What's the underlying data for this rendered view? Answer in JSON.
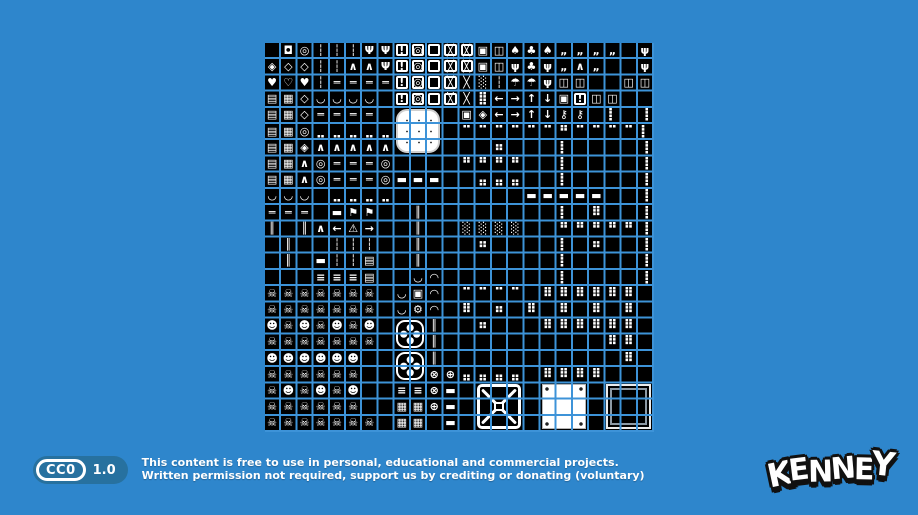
{
  "page": {
    "background_color": "#2e86cc"
  },
  "tileset": {
    "description": "1-bit monochrome tileset preview, 24x24 tiles, white pixel art on black with blue grid lines",
    "columns": 24,
    "rows": 24,
    "tile_color": "#000000",
    "ink_color": "#ffffff",
    "grid_line_color": "#3d93d8",
    "legend": {
      ".": {
        "glyph": "",
        "label": "empty-tile"
      },
      "$": {
        "glyph": "◘",
        "label": "small-button"
      },
      "0": {
        "glyph": "◎",
        "label": "ring-button"
      },
      "o": {
        "glyph": "▣",
        "label": "boxed-button"
      },
      "e": {
        "glyph": "◈",
        "label": "ornate-gem"
      },
      "G": {
        "glyph": "◇",
        "label": "gem-outline"
      },
      "h": {
        "glyph": "♥",
        "label": "heart"
      },
      "H": {
        "glyph": "♡",
        "label": "heart-outline"
      },
      "i": {
        "glyph": "┆",
        "label": "chain"
      },
      "k": {
        "glyph": "Ψ",
        "label": "grapple-hook"
      },
      "K": {
        "glyph": "⚷",
        "label": "key"
      },
      "b": {
        "glyph": "!",
        "frame": true,
        "label": "exclamation-box"
      },
      "C": {
        "glyph": "◎",
        "frame": true,
        "label": "button-box"
      },
      "d": {
        "glyph": "",
        "frame": true,
        "label": "empty-box"
      },
      "X": {
        "glyph": "╳",
        "frame": true,
        "label": "crossed-box"
      },
      "x": {
        "glyph": "╳",
        "label": "cross-tile"
      },
      "L": {
        "glyph": "▤",
        "label": "ladder"
      },
      "r": {
        "glyph": "▦",
        "label": "rails"
      },
      "t": {
        "glyph": "♠",
        "label": "tree-small"
      },
      "T": {
        "glyph": "♣",
        "label": "tree-large"
      },
      "m": {
        "glyph": "☂",
        "label": "mushroom"
      },
      "p": {
        "glyph": "ψ",
        "label": "plant"
      },
      "v": {
        "glyph": "„",
        "label": "grass-tuft"
      },
      "z": {
        "glyph": "∧",
        "label": "zigzag-spikes"
      },
      "~": {
        "glyph": "═",
        "label": "bridge-deck"
      },
      "(": {
        "glyph": "◡",
        "label": "hanging-rope-left"
      },
      ")": {
        "glyph": "◠",
        "label": "arch-rope"
      },
      "a": {
        "glyph": "→",
        "label": "arrow-right-sign"
      },
      "A": {
        "glyph": "←",
        "label": "arrow-left-sign"
      },
      "u": {
        "glyph": "↑",
        "label": "arrow-up-sign"
      },
      "n": {
        "glyph": "↓",
        "label": "arrow-down-sign"
      },
      "D": {
        "glyph": "◫",
        "label": "door"
      },
      "E": {
        "glyph": "⚑",
        "label": "signpost-flag"
      },
      "Y": {
        "glyph": "⚠",
        "label": "warning-sign"
      },
      "s": {
        "glyph": "☠",
        "label": "skull-creature"
      },
      "S": {
        "glyph": "☻",
        "label": "creature-face"
      },
      "f": {
        "glyph": "⊕",
        "label": "small-fan"
      },
      "j": {
        "glyph": "⊗",
        "label": "small-fan-x"
      },
      "I": {
        "glyph": "║",
        "label": "pipe-post"
      },
      "=": {
        "glyph": "≡",
        "label": "fence"
      },
      "@": {
        "glyph": "▬",
        "label": "platform"
      },
      "&": {
        "glyph": "⚙",
        "label": "gear"
      },
      "N": {
        "glyph": "░",
        "label": "hazard-stripes"
      },
      "8": {
        "glyph": "⣿",
        "size": 13,
        "label": "speckled-block"
      },
      "1": {
        "glyph": "⠛",
        "size": 13,
        "label": "dotted-edge-top"
      },
      "2": {
        "glyph": "⣤",
        "size": 13,
        "label": "dotted-edge-bottom"
      },
      "3": {
        "glyph": "⡇",
        "size": 13,
        "label": "dotted-edge-left"
      },
      "4": {
        "glyph": "⢸",
        "size": 13,
        "label": "dotted-edge-right"
      },
      "5": {
        "glyph": "⠿",
        "size": 13,
        "label": "dotted-terrain"
      },
      "6": {
        "glyph": "⣀",
        "size": 13,
        "label": "ground-dots"
      },
      "7": {
        "glyph": "⠉",
        "size": 13,
        "label": "ceiling-dots"
      },
      "9": {
        "glyph": "⠶",
        "size": 13,
        "label": "scatter-dots"
      }
    },
    "map": [
      ".$0iiikkbCdXXoDtTtvvvv.p",
      "eGGiizzkbCdXXoDpTpvzv..p",
      "hHhi~~~~bCdXxNimmpDD..DD",
      "LrG((((.bCdXx8AaunobDD..",
      "LrG~~~~.....oeAaunKK.3.4",
      "Lr066666....777777177773",
      "Lrezzzzz......9...3....4",
      "Lrz0~~~0....1111..3....4",
      "Lrz0~~~0@@@..222..3....4",
      "(((.6666........@@@@@..4",
      "~~~.@EE..I........3.5..4",
      "I.IzAYa..I..NNNN..111114",
      ".I..iii..I...9....3.9..4",
      ".I.@iiL..I........3....4",
      "...===L..().......3....4",
      "sssssss.(o).7777.555555.",
      "sssssss.(&).5.9.5.5.5.5.",
      "SsSsSsS...I..9...555555.",
      "sssssss...I..........55.",
      "SSSSSS....I...........5.",
      "ssssss....jf2222.5555...",
      "sSsSsS..==j@............",
      "ssssss..rrf@............",
      "sssssss.rr.@............"
    ],
    "overlays": [
      {
        "name": "white-rounded-blob",
        "type": "white-round",
        "col": 9,
        "row": 5,
        "cols": 3,
        "rows": 3
      },
      {
        "name": "large-fan-top",
        "type": "fan",
        "col": 9,
        "row": 18,
        "cols": 2,
        "rows": 2
      },
      {
        "name": "large-fan-bottom",
        "type": "fan",
        "col": 9,
        "row": 20,
        "cols": 2,
        "rows": 2
      },
      {
        "name": "crate-cross-3x3",
        "type": "crate",
        "col": 14,
        "row": 22,
        "cols": 3,
        "rows": 3
      },
      {
        "name": "white-square-3x3",
        "type": "white-square",
        "col": 18,
        "row": 22,
        "cols": 3,
        "rows": 3
      },
      {
        "name": "black-square-3x3",
        "type": "black-square",
        "col": 22,
        "row": 22,
        "cols": 3,
        "rows": 3
      }
    ]
  },
  "license": {
    "badge_cc": "CC0",
    "badge_version": "1.0",
    "badge_color": "#27719f",
    "line1": "This content is free to use in personal, educational and commercial projects.",
    "line2": "Written permission not required, support us by crediting or donating (voluntary)"
  },
  "logo": {
    "text": "KENNEY"
  }
}
